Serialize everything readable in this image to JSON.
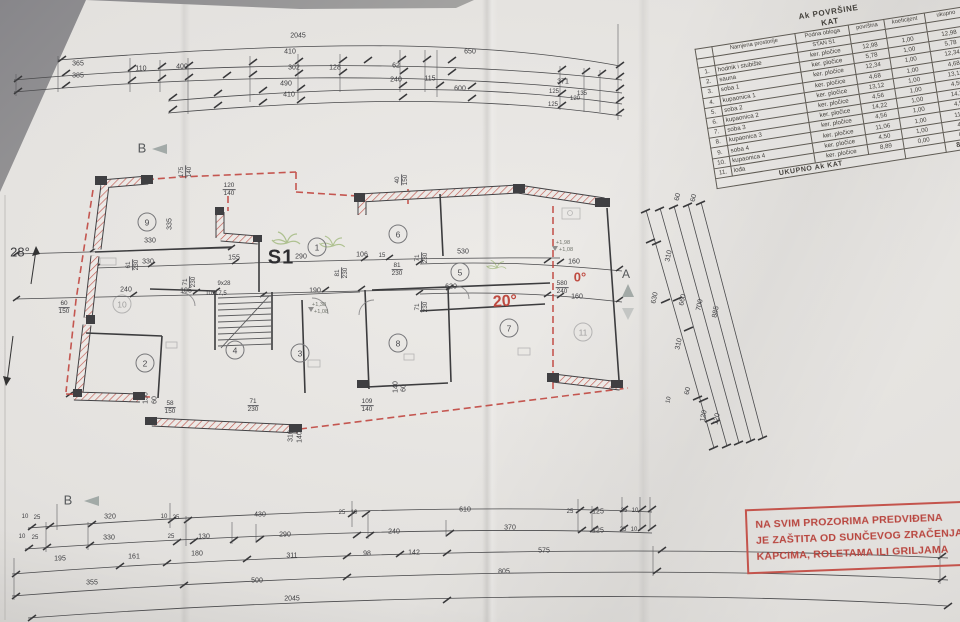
{
  "table": {
    "title_line1": "Ak POVRŠINE",
    "title_line2": "KAT",
    "columns": [
      "Namjena prostorije",
      "Podna obloga",
      "površina",
      "koeficijent",
      "ukupno"
    ],
    "subheader": "STAN S1",
    "rows": [
      [
        "1.",
        "hodnik i stubište",
        "ker. pločice",
        "12,98",
        "1,00",
        "12,98"
      ],
      [
        "2.",
        "sauna",
        "ker. pločice",
        "5,78",
        "1,00",
        "5,78"
      ],
      [
        "3.",
        "soba 1",
        "ker. pločice",
        "12,34",
        "1,00",
        "12,34"
      ],
      [
        "4.",
        "kupaonica 1",
        "ker. pločice",
        "4,68",
        "1,00",
        "4,68"
      ],
      [
        "5.",
        "soba 2",
        "ker. pločice",
        "13,12",
        "1,00",
        "13,12"
      ],
      [
        "6.",
        "kupaonica 2",
        "ker. pločice",
        "4,56",
        "1,00",
        "4,56"
      ],
      [
        "7.",
        "soba 3",
        "ker. pločice",
        "14,22",
        "1,00",
        "14,22"
      ],
      [
        "8.",
        "kupaonica 3",
        "ker. pločice",
        "4,56",
        "1,00",
        "4,56"
      ],
      [
        "9.",
        "soba 4",
        "ker. pločice",
        "11,06",
        "1,00",
        "11,06"
      ],
      [
        "10.",
        "kupaonica 4",
        "ker. pločice",
        "4,50",
        "1,00",
        "4,50"
      ],
      [
        "11.",
        "lođa",
        "ker. pločice",
        "8,89",
        "0,00",
        "0,00"
      ]
    ],
    "total_label": "UKUPNO Ak KAT",
    "total_value": "87,26"
  },
  "stamp": {
    "line1": "NA SVIM PROZORIMA PREDVIĐENA",
    "line2": "JE ZAŠTITA OD SUNČEVOG ZRAČENJA",
    "line3": "KAPCIMA, ROLETAMA ILI GRILJAMA",
    "color": "#b8443d"
  },
  "plan": {
    "unit_label": "S1",
    "roof_slope_left": "28°",
    "roof_slope_right_flat": "0°",
    "roof_slope_right": "20°",
    "section_b": "B",
    "section_a": "A",
    "rooms": [
      "1",
      "2",
      "3",
      "4",
      "5",
      "6",
      "7",
      "8",
      "9",
      "10",
      "11"
    ]
  },
  "dims": {
    "top": [
      "2045",
      "410",
      "650",
      "365",
      "385",
      "110",
      "400",
      "302",
      "128",
      "62",
      "240",
      "115",
      "490",
      "410",
      "600",
      "371",
      "135",
      "125",
      "125",
      "120"
    ],
    "plan": [
      "330",
      "330",
      "335",
      "240",
      "105",
      "155",
      "290",
      "106",
      "15",
      "190",
      "9x28",
      "10x17,5",
      "230",
      "530",
      "620",
      "160",
      "160",
      "150",
      "60",
      "310",
      "140",
      "140",
      "60",
      "+1,98",
      "+1,08",
      "+1,38",
      "+1,08"
    ],
    "plan_fracs": [
      [
        "120",
        "140"
      ],
      [
        "175",
        "140"
      ],
      [
        "40",
        "150"
      ],
      [
        "61",
        "230"
      ],
      [
        "71",
        "230"
      ],
      [
        "81",
        "230"
      ],
      [
        "81",
        "230"
      ],
      [
        "71",
        "230"
      ],
      [
        "71",
        "230"
      ],
      [
        "580",
        "240"
      ],
      [
        "60",
        "150"
      ],
      [
        "58",
        "150"
      ],
      [
        "71",
        "230"
      ],
      [
        "109",
        "140"
      ]
    ],
    "right": [
      "60",
      "60",
      "310",
      "630",
      "660",
      "700",
      "885",
      "310",
      "60",
      "10",
      "120",
      "120"
    ],
    "bottom": [
      "10",
      "25",
      "320",
      "10",
      "25",
      "430",
      "25",
      "10",
      "610",
      "25",
      "125",
      "25",
      "10",
      "10",
      "25",
      "330",
      "25",
      "130",
      "290",
      "240",
      "370",
      "125",
      "25",
      "10",
      "195",
      "161",
      "180",
      "311",
      "98",
      "142",
      "575",
      "355",
      "500",
      "805",
      "2045"
    ]
  },
  "colors": {
    "wall_hatch": "#c05a52",
    "roof_dash": "#bf423b",
    "ink": "#3d3d40",
    "stamp_red": "#c4544c",
    "plant_green": "#7fa24c"
  }
}
